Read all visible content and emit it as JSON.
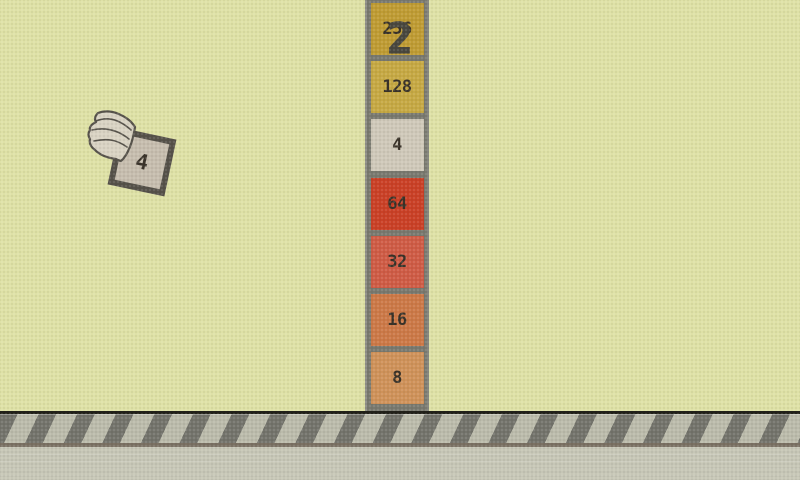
{
  "scene": {
    "score": "2",
    "background_color": "#dee1a6",
    "score_color": "#4a483f"
  },
  "player_tile": {
    "value": "4",
    "bg": "#c6bdae",
    "border": "#56524a",
    "text_color": "#3b342b"
  },
  "pipe": {
    "frame_color": "#79796f",
    "tile_text_color": "#3a3329",
    "tiles": [
      {
        "value": "256",
        "bg": "#bf9c34"
      },
      {
        "value": "128",
        "bg": "#c6a944"
      },
      {
        "value": "4",
        "bg": "#cfc8b9"
      },
      {
        "value": "64",
        "bg": "#ca4127"
      },
      {
        "value": "32",
        "bg": "#cf5c46"
      },
      {
        "value": "16",
        "bg": "#cc7948"
      },
      {
        "value": "8",
        "bg": "#cf925a"
      }
    ]
  },
  "ground": {
    "top_line_color": "#22211a",
    "stripe_band_bg": "#bbbbab",
    "stripe_color": "#74746c",
    "divider_color": "#7b7264",
    "base_color": "#c6c6b6"
  }
}
